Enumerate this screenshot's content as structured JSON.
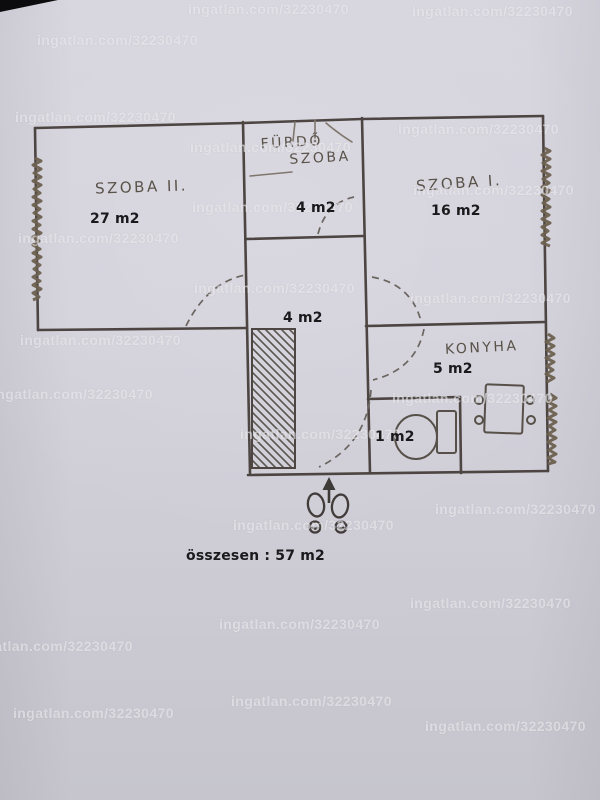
{
  "watermark": {
    "text": "ingatlan.com/32230470",
    "positions": [
      [
        188,
        1
      ],
      [
        412,
        3
      ],
      [
        37,
        32
      ],
      [
        15,
        109
      ],
      [
        398,
        121
      ],
      [
        190,
        139
      ],
      [
        413,
        182
      ],
      [
        192,
        199
      ],
      [
        18,
        230
      ],
      [
        194,
        280
      ],
      [
        410,
        290
      ],
      [
        20,
        332
      ],
      [
        -8,
        386
      ],
      [
        392,
        390
      ],
      [
        240,
        426
      ],
      [
        435,
        501
      ],
      [
        233,
        517
      ],
      [
        410,
        595
      ],
      [
        219,
        616
      ],
      [
        -28,
        638
      ],
      [
        231,
        693
      ],
      [
        13,
        705
      ],
      [
        425,
        718
      ]
    ]
  },
  "floorplan": {
    "rooms": {
      "szoba2": {
        "name": "SZOBA II.",
        "area": "27 m2"
      },
      "furdo": {
        "name_line1": "FÜRDŐ",
        "name_line2": "SZOBA",
        "area": "4 m2"
      },
      "szoba1": {
        "name": "SZOBA I.",
        "area": "16 m2"
      },
      "hall": {
        "area": "4 m2"
      },
      "konyha": {
        "name": "KONYHA",
        "area": "5 m2"
      },
      "wc": {
        "area": "1 m2"
      }
    },
    "total": "összesen : 57 m2"
  }
}
